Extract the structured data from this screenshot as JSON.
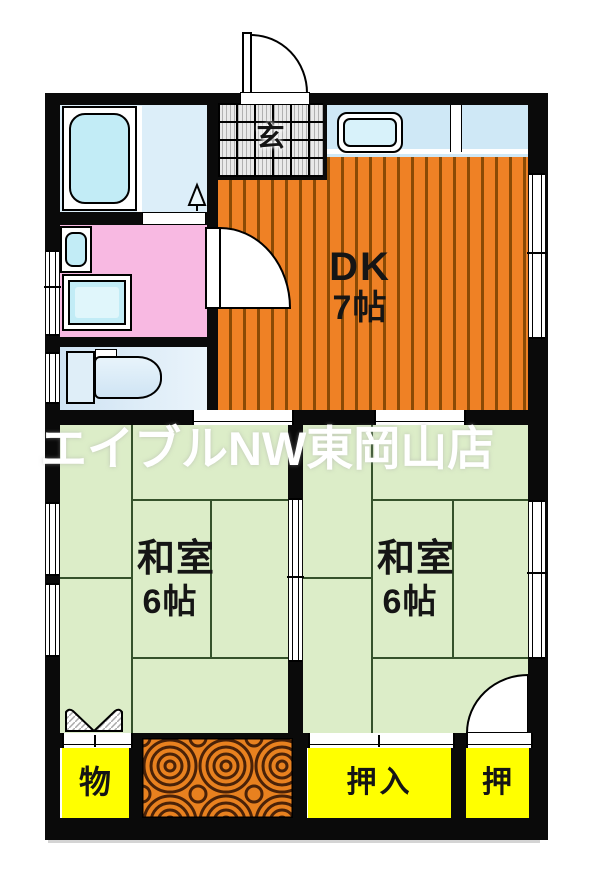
{
  "watermark": "エイブルNW東岡山店",
  "rooms": {
    "entrance": {
      "label": "玄"
    },
    "dining_kitchen": {
      "label": "DK",
      "size": "7帖"
    },
    "japanese_room_left": {
      "label": "和室",
      "size": "6帖"
    },
    "japanese_room_right": {
      "label": "和室",
      "size": "6帖"
    },
    "storage": {
      "label": "物"
    },
    "closet_large": {
      "label": "押入"
    },
    "closet_small": {
      "label": "押"
    }
  },
  "fixtures": {
    "bathtub": "bathtub-icon",
    "shower": "shower-icon",
    "washing_machine": "washing-machine-icon",
    "washbasin": "washbasin-icon",
    "toilet": "toilet-icon",
    "kitchen_sink": "kitchen-sink-icon",
    "entrance_door": "entrance-door-icon",
    "washroom_door": "door-swing-icon",
    "room_door": "door-swing-icon",
    "bifold_door": "bifold-door-icon",
    "wood_floor": "wood-floor"
  },
  "colors": {
    "wall": "#0a0a0a",
    "floor_orange": "#ef8125",
    "stripe_brown": "#8a4a05",
    "tatami_green": "#dcedc8",
    "tatami_line": "#35522b",
    "closet_yellow": "#ffff00",
    "pink": "#f8b9e2",
    "cyan": "#c2ecf6",
    "pale_blue": "#dceef9",
    "counter_blue": "#cfe8f6",
    "toilet_blue": "#cfe3f3",
    "wood_orange": "#e8811f",
    "wood_grain": "#4a2208",
    "watermark": "#ffffff"
  }
}
